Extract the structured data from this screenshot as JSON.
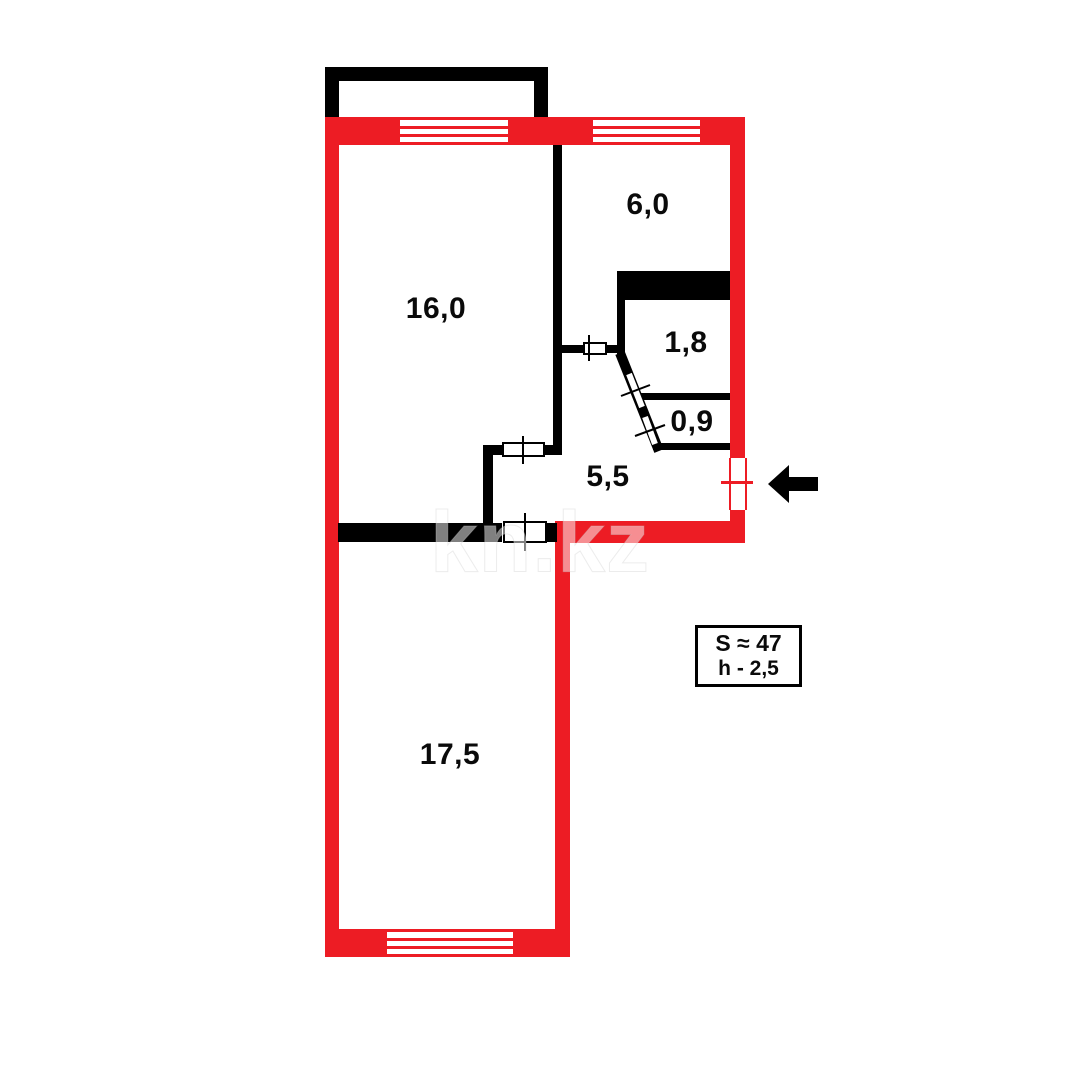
{
  "colors": {
    "wall_red": "#ED1C24",
    "wall_black": "#000000",
    "background": "#FFFFFF"
  },
  "watermark": {
    "text": "kn.kz"
  },
  "plan": {
    "rooms": [
      {
        "id": "living-room",
        "label": "16,0"
      },
      {
        "id": "kitchen",
        "label": "6,0"
      },
      {
        "id": "closet",
        "label": "1,8"
      },
      {
        "id": "bathroom",
        "label": "0,9"
      },
      {
        "id": "hallway",
        "label": "5,5"
      },
      {
        "id": "bedroom",
        "label": "17,5"
      }
    ],
    "info_box": {
      "line1": "S ≈ 47",
      "line2": "h - 2,5"
    }
  }
}
